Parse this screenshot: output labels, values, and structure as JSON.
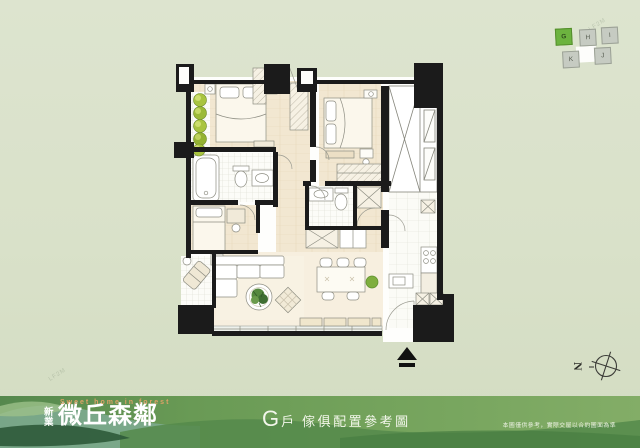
{
  "locator": {
    "units": [
      {
        "id": "G",
        "highlighted": true
      },
      {
        "id": "H",
        "highlighted": false
      },
      {
        "id": "I",
        "highlighted": false
      },
      {
        "id": "K",
        "highlighted": false
      },
      {
        "id": "J",
        "highlighted": false
      }
    ],
    "highlight_color": "#6cb33f",
    "normal_color": "#c6cbc2"
  },
  "compass": {
    "north_label": "N"
  },
  "footer": {
    "logo_cn_small": "新業",
    "logo_cn_large": "微丘森鄰",
    "logo_en": "Sweet home in forest",
    "caption_unit": "G",
    "caption_suffix": "戶",
    "caption_text": "傢俱配置參考圖",
    "disclaimer": "本圖僅供參考，實際交屋以合約圖面為準"
  },
  "watermark": {
    "text": "LF2M"
  },
  "colors": {
    "background": "#d9e1c9",
    "wall": "#1b1b1b",
    "accent_green": "#6cb33f",
    "footer_green": "#6f9e55",
    "floor_wood": "#f2e7d2"
  }
}
